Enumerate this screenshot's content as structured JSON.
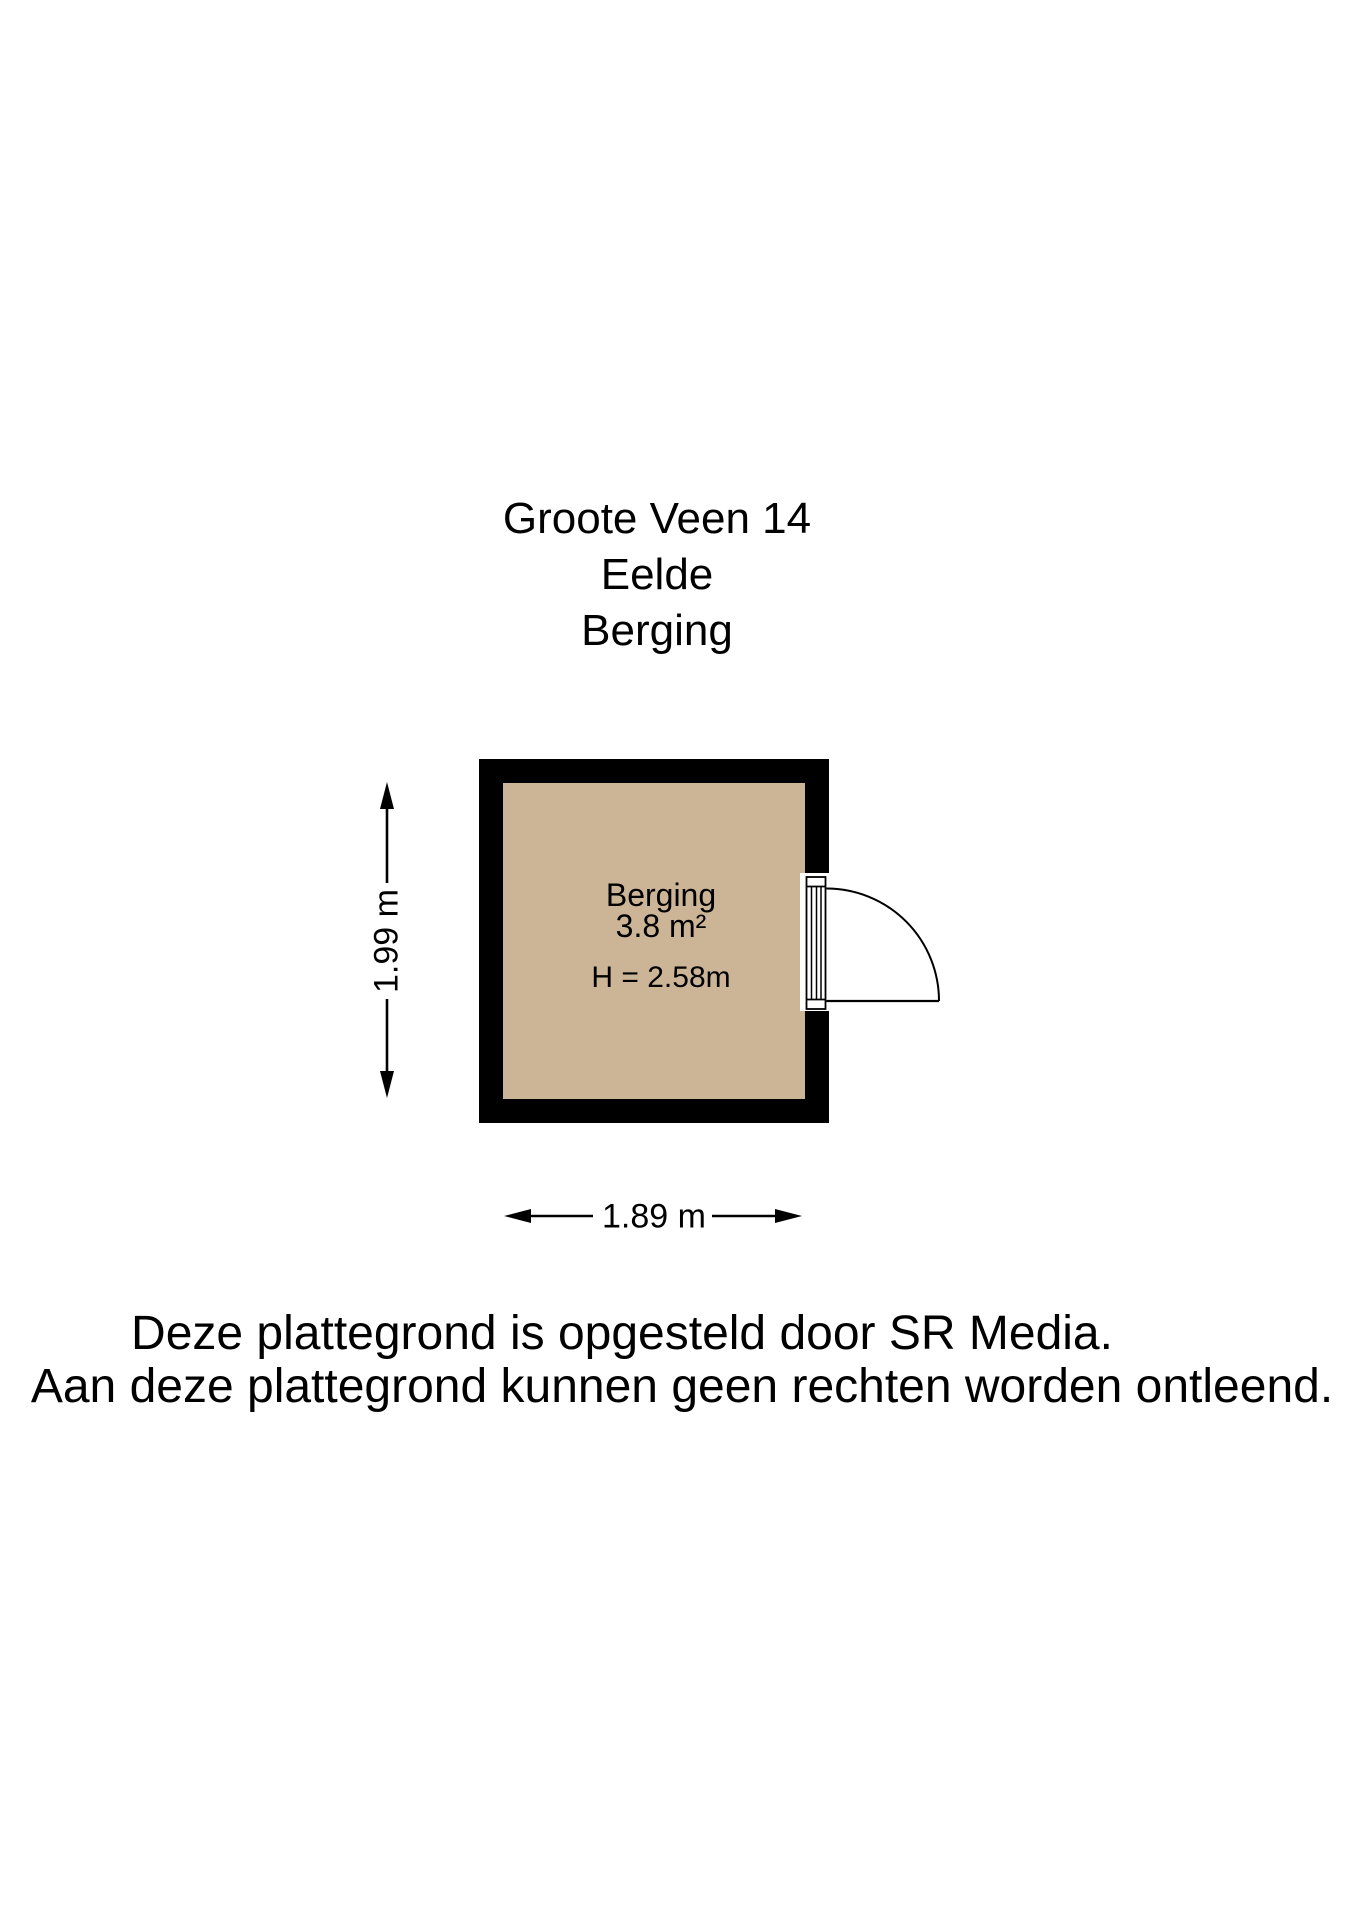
{
  "title": {
    "line1": "Groote Veen 14",
    "line2": "Eelde",
    "line3": "Berging"
  },
  "room": {
    "name": "Berging",
    "area": "3.8 m²",
    "ceiling_height": "H = 2.58m"
  },
  "dimensions": {
    "height_label": "1.99 m",
    "width_label": "1.89 m"
  },
  "footer": {
    "line1": "Deze plattegrond is opgesteld door SR Media.",
    "line2": "Aan deze plattegrond kunnen geen rechten worden ontleend."
  },
  "colors": {
    "background": "#ffffff",
    "wall": "#000000",
    "floor": "#ccb496",
    "lines": "#000000"
  }
}
